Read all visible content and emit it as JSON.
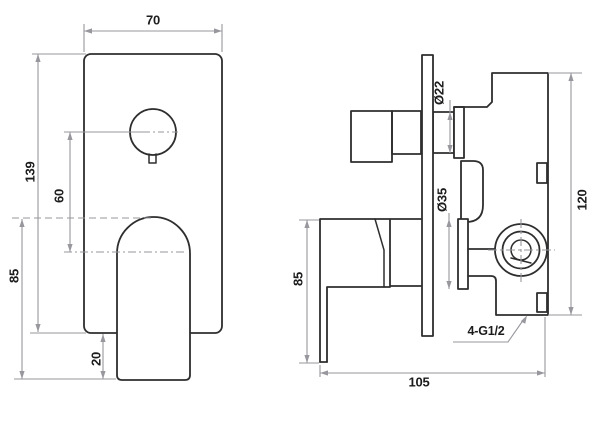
{
  "drawing": {
    "kind": "orthographic technical drawing",
    "subject": "concealed shower mixer valve, front view and side view",
    "background": "#ffffff",
    "object_line_color": "#2e2e2e",
    "dimension_line_color": "#97979d",
    "text_color": "#1c1c1c"
  },
  "front_view": {
    "name": "front view (wall plate with knob and lever handle)",
    "labels": {
      "plate_width": "70",
      "plate_height": "139",
      "knob_to_handle_offset": "60",
      "handle_length": "85",
      "handle_overhang": "20"
    }
  },
  "side_view": {
    "name": "side view (valve body behind wall plate)",
    "labels": {
      "stub_diameter": "Ø22",
      "hub_diameter": "Ø35",
      "body_height": "120",
      "handle_height": "85",
      "overall_depth": "105",
      "thread_callout": "4-G1/2"
    }
  }
}
